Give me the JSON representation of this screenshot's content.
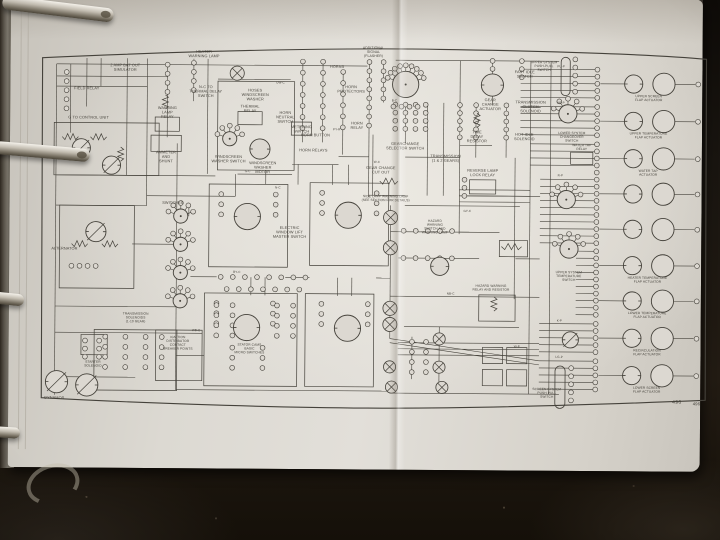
{
  "scene": {
    "table_color": "#17120d",
    "page_color": "#dcd8d1",
    "ink_color": "#45423b",
    "ring_metal": "#d8d3c9"
  },
  "figure_number": "496",
  "diagram": {
    "border": "M6,16 C160,8 300,4 400,5 C520,6 620,9 664,13 L665,351 C560,356 430,361 330,361 C220,361 90,357 7,353 Z",
    "wires": [
      [
        20,
        22,
        328,
        22
      ],
      [
        356,
        16,
        518,
        16
      ],
      [
        20,
        34,
        130,
        34
      ],
      [
        20,
        44,
        110,
        44
      ],
      [
        180,
        36,
        252,
        36
      ],
      [
        20,
        132,
        178,
        132
      ],
      [
        110,
        152,
        198,
        152
      ],
      [
        20,
        162,
        110,
        162
      ],
      [
        96,
        200,
        142,
        200
      ],
      [
        20,
        262,
        140,
        262
      ],
      [
        20,
        288,
        166,
        288
      ],
      [
        12,
        332,
        100,
        332
      ],
      [
        140,
        344,
        352,
        344
      ],
      [
        352,
        346,
        520,
        346
      ],
      [
        154,
        232,
        180,
        232
      ],
      [
        248,
        232,
        272,
        232
      ],
      [
        338,
        232,
        352,
        232
      ],
      [
        254,
        120,
        300,
        120
      ],
      [
        300,
        112,
        330,
        112
      ],
      [
        366,
        112,
        420,
        112
      ],
      [
        420,
        100,
        452,
        100
      ],
      [
        330,
        150,
        366,
        150
      ],
      [
        366,
        160,
        480,
        160
      ],
      [
        352,
        186,
        430,
        186
      ],
      [
        360,
        212,
        440,
        212
      ],
      [
        352,
        250,
        440,
        250
      ],
      [
        366,
        280,
        480,
        280
      ],
      [
        140,
        310,
        168,
        310
      ],
      [
        200,
        130,
        254,
        130
      ],
      [
        420,
        150,
        500,
        150
      ],
      [
        420,
        186,
        460,
        186
      ],
      [
        476,
        212,
        500,
        212
      ],
      [
        440,
        250,
        500,
        250
      ],
      [
        480,
        62,
        500,
        62
      ],
      [
        334,
        90,
        334,
        150
      ],
      [
        20,
        22,
        20,
        350
      ],
      [
        34,
        22,
        34,
        90
      ],
      [
        50,
        16,
        50,
        64
      ],
      [
        64,
        16,
        64,
        44
      ],
      [
        90,
        16,
        90,
        132
      ],
      [
        110,
        16,
        110,
        162
      ],
      [
        130,
        22,
        130,
        94
      ],
      [
        140,
        100,
        140,
        344
      ],
      [
        156,
        16,
        156,
        58
      ],
      [
        170,
        16,
        170,
        130
      ],
      [
        198,
        130,
        198,
        152
      ],
      [
        264,
        16,
        264,
        98
      ],
      [
        284,
        16,
        284,
        98
      ],
      [
        304,
        26,
        304,
        110
      ],
      [
        330,
        16,
        330,
        152
      ],
      [
        344,
        16,
        344,
        58
      ],
      [
        366,
        58,
        366,
        98
      ],
      [
        388,
        58,
        388,
        150
      ],
      [
        404,
        58,
        404,
        150
      ],
      [
        420,
        16,
        420,
        188
      ],
      [
        436,
        58,
        436,
        112
      ],
      [
        452,
        16,
        452,
        60
      ],
      [
        466,
        58,
        466,
        112
      ],
      [
        475,
        112,
        475,
        252
      ],
      [
        490,
        16,
        490,
        346
      ],
      [
        510,
        16,
        510,
        346
      ],
      [
        352,
        160,
        352,
        292
      ],
      [
        310,
        120,
        310,
        140
      ],
      [
        294,
        120,
        294,
        140
      ],
      [
        260,
        120,
        260,
        140
      ],
      [
        228,
        126,
        228,
        140
      ],
      [
        214,
        232,
        214,
        250
      ],
      [
        228,
        232,
        228,
        250
      ],
      [
        300,
        232,
        300,
        250
      ],
      [
        314,
        232,
        314,
        250
      ],
      [
        374,
        290,
        374,
        332
      ],
      [
        401,
        280,
        401,
        346
      ],
      [
        152,
        162,
        152,
        172
      ],
      [
        352,
        292,
        500,
        313
      ],
      [
        352,
        296,
        500,
        317
      ]
    ],
    "bundles": [
      [
        480,
        556,
        24,
        5,
        7
      ],
      [
        480,
        556,
        61,
        5,
        7
      ],
      [
        490,
        556,
        98,
        4,
        7
      ],
      [
        500,
        556,
        133,
        5,
        7
      ],
      [
        500,
        556,
        168,
        5,
        7
      ],
      [
        536,
        556,
        204,
        5,
        7
      ],
      [
        536,
        556,
        239,
        5,
        7
      ],
      [
        500,
        556,
        276,
        5,
        7
      ],
      [
        500,
        556,
        313,
        5,
        7
      ],
      [
        360,
        500,
        296,
        3,
        6
      ],
      [
        420,
        490,
        144,
        3,
        6
      ]
    ],
    "terminal_runs": [
      [
        30,
        30,
        5,
        9
      ],
      [
        130,
        22,
        4,
        9
      ],
      [
        156,
        20,
        4,
        9
      ],
      [
        264,
        18,
        7,
        11
      ],
      [
        284,
        18,
        7,
        11
      ],
      [
        304,
        28,
        6,
        11
      ],
      [
        330,
        18,
        8,
        9
      ],
      [
        344,
        18,
        5,
        9
      ],
      [
        356,
        60,
        4,
        8
      ],
      [
        366,
        60,
        4,
        8
      ],
      [
        376,
        60,
        4,
        8
      ],
      [
        386,
        60,
        4,
        8
      ],
      [
        420,
        60,
        5,
        8
      ],
      [
        436,
        60,
        5,
        8
      ],
      [
        466,
        60,
        5,
        8
      ],
      [
        452,
        16,
        3,
        8
      ],
      [
        481,
        16,
        3,
        8
      ],
      [
        184,
        150,
        3,
        10
      ],
      [
        238,
        150,
        3,
        10
      ],
      [
        284,
        148,
        3,
        10
      ],
      [
        338,
        148,
        3,
        10
      ],
      [
        180,
        258,
        3,
        10
      ],
      [
        236,
        258,
        3,
        10
      ],
      [
        284,
        258,
        3,
        10
      ],
      [
        330,
        258,
        3,
        10
      ],
      [
        184,
        232,
        8,
        12,
        "h"
      ],
      [
        190,
        244,
        7,
        12,
        "h"
      ],
      [
        365,
        185,
        5,
        12,
        "h"
      ],
      [
        365,
        212,
        5,
        12,
        "h"
      ],
      [
        534,
        14,
        5,
        8
      ],
      [
        532,
        320,
        5,
        8
      ],
      [
        374,
        295,
        4,
        10
      ],
      [
        388,
        295,
        4,
        10
      ],
      [
        50,
        296,
        3,
        8
      ],
      [
        64,
        296,
        3,
        8
      ],
      [
        70,
        292,
        4,
        10
      ],
      [
        90,
        292,
        4,
        10
      ],
      [
        110,
        292,
        4,
        10
      ],
      [
        126,
        292,
        4,
        10
      ],
      [
        180,
        260,
        4,
        10
      ],
      [
        196,
        260,
        4,
        10
      ],
      [
        240,
        260,
        4,
        10
      ],
      [
        256,
        260,
        4,
        10
      ],
      [
        196,
        302,
        3,
        10
      ],
      [
        226,
        302,
        3,
        10
      ],
      [
        425,
        134,
        3,
        8
      ],
      [
        36,
        222,
        4,
        8,
        "h"
      ]
    ],
    "boxes": [
      [
        18,
        80,
        104,
        52
      ],
      [
        24,
        162,
        74,
        82
      ],
      [
        114,
        92,
        30,
        16
      ],
      [
        118,
        74,
        24,
        14
      ],
      [
        180,
        38,
        76,
        88
      ],
      [
        200,
        68,
        24,
        13
      ],
      [
        253,
        78,
        20,
        13
      ],
      [
        172,
        140,
        78,
        82
      ],
      [
        272,
        138,
        78,
        82
      ],
      [
        168,
        248,
        92,
        92
      ],
      [
        268,
        248,
        68,
        92
      ],
      [
        120,
        285,
        46,
        50
      ],
      [
        59,
        285,
        82,
        60
      ],
      [
        46,
        290,
        26,
        20
      ],
      [
        430,
        134,
        26,
        14
      ],
      [
        440,
        248,
        36,
        26
      ],
      [
        460,
        194,
        28,
        16
      ],
      [
        530,
        106,
        22,
        12
      ],
      [
        444,
        300,
        20,
        16
      ],
      [
        468,
        300,
        20,
        16
      ],
      [
        444,
        322,
        20,
        16
      ],
      [
        468,
        322,
        20,
        16
      ]
    ],
    "pills": [
      [
        520,
        12,
        9,
        38
      ],
      [
        516,
        318,
        10,
        42
      ]
    ],
    "motors": [
      [
        210,
        172,
        13
      ],
      [
        310,
        170,
        13
      ],
      [
        210,
        282,
        13
      ],
      [
        310,
        282,
        13
      ],
      [
        222,
        105,
        10
      ],
      [
        452,
        40,
        11
      ],
      [
        45,
        105,
        9,
        1
      ],
      [
        75,
        122,
        9,
        1
      ],
      [
        22,
        337,
        11,
        1
      ],
      [
        52,
        340,
        11,
        1
      ],
      [
        401,
        220,
        9
      ],
      [
        531,
        292,
        8,
        1
      ],
      [
        60,
        188,
        10,
        1
      ]
    ],
    "lamps": [
      [
        199,
        30,
        7
      ],
      [
        352,
        172,
        7
      ],
      [
        352,
        202,
        7
      ],
      [
        352,
        262,
        7
      ],
      [
        352,
        278,
        7
      ],
      [
        352,
        320,
        6
      ],
      [
        354,
        340,
        6
      ],
      [
        401,
        292,
        6
      ],
      [
        401,
        320,
        6
      ],
      [
        404,
        340,
        6
      ]
    ],
    "rotaries": [
      [
        366,
        40,
        13,
        1
      ],
      [
        144,
        172,
        7
      ],
      [
        144,
        200,
        7
      ],
      [
        144,
        228,
        7
      ],
      [
        144,
        256,
        7
      ],
      [
        192,
        95,
        7
      ],
      [
        527,
        68,
        9
      ],
      [
        526,
        153,
        9
      ],
      [
        529,
        202,
        9
      ]
    ],
    "resistors": [
      [
        128,
        52,
        "v",
        14
      ],
      [
        437,
        68,
        "v",
        14
      ],
      [
        455,
        250,
        "v",
        14
      ],
      [
        462,
        200,
        "h",
        20
      ],
      [
        341,
        136,
        "h",
        18
      ],
      [
        26,
        94,
        "h",
        16
      ],
      [
        54,
        94,
        "h",
        16
      ],
      [
        84,
        104,
        "v",
        14
      ],
      [
        36,
        200,
        "h",
        16
      ],
      [
        66,
        200,
        "h",
        16
      ]
    ],
    "actuator_rows": [
      {
        "y": 38,
        "label": "UPPER SCREEN\nFLAP ACTUATOR"
      },
      {
        "y": 75,
        "label": "UPPER TEMPERATURE\nFLAP ACTUATOR"
      },
      {
        "y": 112,
        "label": "WATER TAP\nACTUATOR"
      },
      {
        "y": 147,
        "label": ""
      },
      {
        "y": 182,
        "label": ""
      },
      {
        "y": 218,
        "label": "HEATER TEMPERATURE\nFLAP ACTUATOR"
      },
      {
        "y": 253,
        "label": "LOWER TEMPERATURE\nFLAP ACTUATOR"
      },
      {
        "y": 290,
        "label": "RECIRCULATION\nFLAP ACTUATOR"
      },
      {
        "y": 327,
        "label": "LOWER SCREEN\nFLAP ACTUATOR"
      }
    ],
    "labels": [
      [
        50,
        47,
        "FIELD RELAY"
      ],
      [
        88,
        24,
        "2 AMP BAT OUT\nSIMULATOR"
      ],
      [
        166,
        10,
        "HEATER\nWARNING LAMP"
      ],
      [
        168,
        45,
        "N-C TO\nTHERMAL DELAY\nSWITCH"
      ],
      [
        52,
        76,
        "G TO CONTROL UNIT"
      ],
      [
        130,
        66,
        "WARNING\nLAMP\nRELAY"
      ],
      [
        129,
        110,
        "AMMETER\nAND\nSHUNT"
      ],
      [
        217,
        48,
        "HOSES\nWINDSCREEN\nWASHER"
      ],
      [
        212,
        64,
        "THERMAL\nRELAY"
      ],
      [
        263,
        84,
        "METERING\nSWITCH"
      ],
      [
        191,
        114,
        "WINDSCREEN\nWASHER SWITCH"
      ],
      [
        225,
        120,
        "WINDSCREEN\nWASHER\nMOTOR"
      ],
      [
        247,
        70,
        "HORN\nNEUTRAL\nSWITCH"
      ],
      [
        298,
        24,
        "HORNS"
      ],
      [
        312,
        44,
        "HORN\nPROTECTORS"
      ],
      [
        277,
        92,
        "HORN BUTTON"
      ],
      [
        318,
        80,
        "HORN\nRELAY"
      ],
      [
        275,
        107,
        "HORN RELAYS"
      ],
      [
        334,
        5,
        "ADDITIONAL\nSIGNAL\n(FLASHER)",
        3.4
      ],
      [
        366,
        100,
        "GEARCHANGE\nSELECTOR SWITCH"
      ],
      [
        450,
        56,
        "GEAR\nCHANGE\nACTUATOR"
      ],
      [
        437,
        88,
        "TIME\nDELAY\nRESISTOR"
      ],
      [
        406,
        112,
        "TRANSMISSION\n(1 & 2 GEARS)"
      ],
      [
        342,
        124,
        "GEAR CHANGE\nCUT OUT"
      ],
      [
        443,
        126,
        "REVERSE LAMP\nLOCK RELAY"
      ],
      [
        484,
        28,
        "FAST IDLE\nSWITCH"
      ],
      [
        490,
        58,
        "TRANSMISSION\nCLUTCH\nSOLENOID"
      ],
      [
        484,
        90,
        "HOT IDLE\nSOLENOID"
      ],
      [
        503,
        18,
        "UPPER SYSTEM\nPUSH-PULL\nSWITCH",
        3.2
      ],
      [
        531,
        88,
        "LOWER SYSTEM\nCHANGEOVER\nSWITCH",
        3.2
      ],
      [
        529,
        226,
        "UPPER SYSTEM\nTEMPERATURE\nSWITCH",
        3.2
      ],
      [
        508,
        342,
        "SCREEN SYSTEM\nPUSH PULL\nSWITCH",
        3.2
      ],
      [
        541,
        100,
        "WATER TAP\nRELAY",
        3.2
      ],
      [
        347,
        152,
        "SIDE LAMP WARNING LAMP\n(SEE SECTION FOR DETAILS)",
        3.2
      ],
      [
        396,
        176,
        "HAZARD\nWARNING\nSWITCH AND\nWARNING LAMP",
        3.2
      ],
      [
        452,
        240,
        "HAZARD WARNING\nRELAY AND RESISTOR",
        3.2
      ],
      [
        252,
        184,
        "ELECTRIC\nWINDOW LIFT\nMASTER SWITCH"
      ],
      [
        136,
        160,
        "SWITCHES"
      ],
      [
        16,
        206,
        "ALTERNATOR",
        3.8,
        "start"
      ],
      [
        100,
        270,
        "TRANSMISSION\nSOLENOIDS\n(1-10 GEAR)",
        3.2
      ],
      [
        58,
        318,
        "STARTER\nSOLENOID",
        3.2
      ],
      [
        10,
        354,
        "DYNAMOS",
        3.8,
        "start"
      ],
      [
        213,
        300,
        "STATOR CAMS\nBASIC\nMICRO SWITCHES",
        3.2
      ],
      [
        142,
        293,
        "IGNITION\nDISTRIBUTOR\nCONTACT\nBREAKER POINTS",
        3.2
      ],
      [
        660,
        356,
        "496",
        4.2,
        "end"
      ],
      [
        240,
        144,
        "N-C",
        3
      ],
      [
        338,
        118,
        "W-C",
        3
      ],
      [
        428,
        166,
        "GY-C",
        3
      ],
      [
        298,
        86,
        "PY-R",
        3
      ],
      [
        200,
        228,
        "BY-C",
        3
      ],
      [
        355,
        57,
        "B-C",
        3
      ],
      [
        520,
        130,
        "R-P",
        3
      ],
      [
        520,
        58,
        "HP-P",
        3
      ],
      [
        520,
        22,
        "PU-P",
        3
      ],
      [
        412,
        248,
        "NB-C",
        3
      ],
      [
        242,
        40,
        "UW-C",
        3
      ],
      [
        520,
        274,
        "K-P",
        3
      ],
      [
        520,
        310,
        "LG-P",
        3
      ],
      [
        160,
        286,
        "WB-C",
        3
      ],
      [
        210,
        128,
        "G-C",
        3
      ],
      [
        478,
        300,
        "W-P",
        3
      ]
    ]
  }
}
